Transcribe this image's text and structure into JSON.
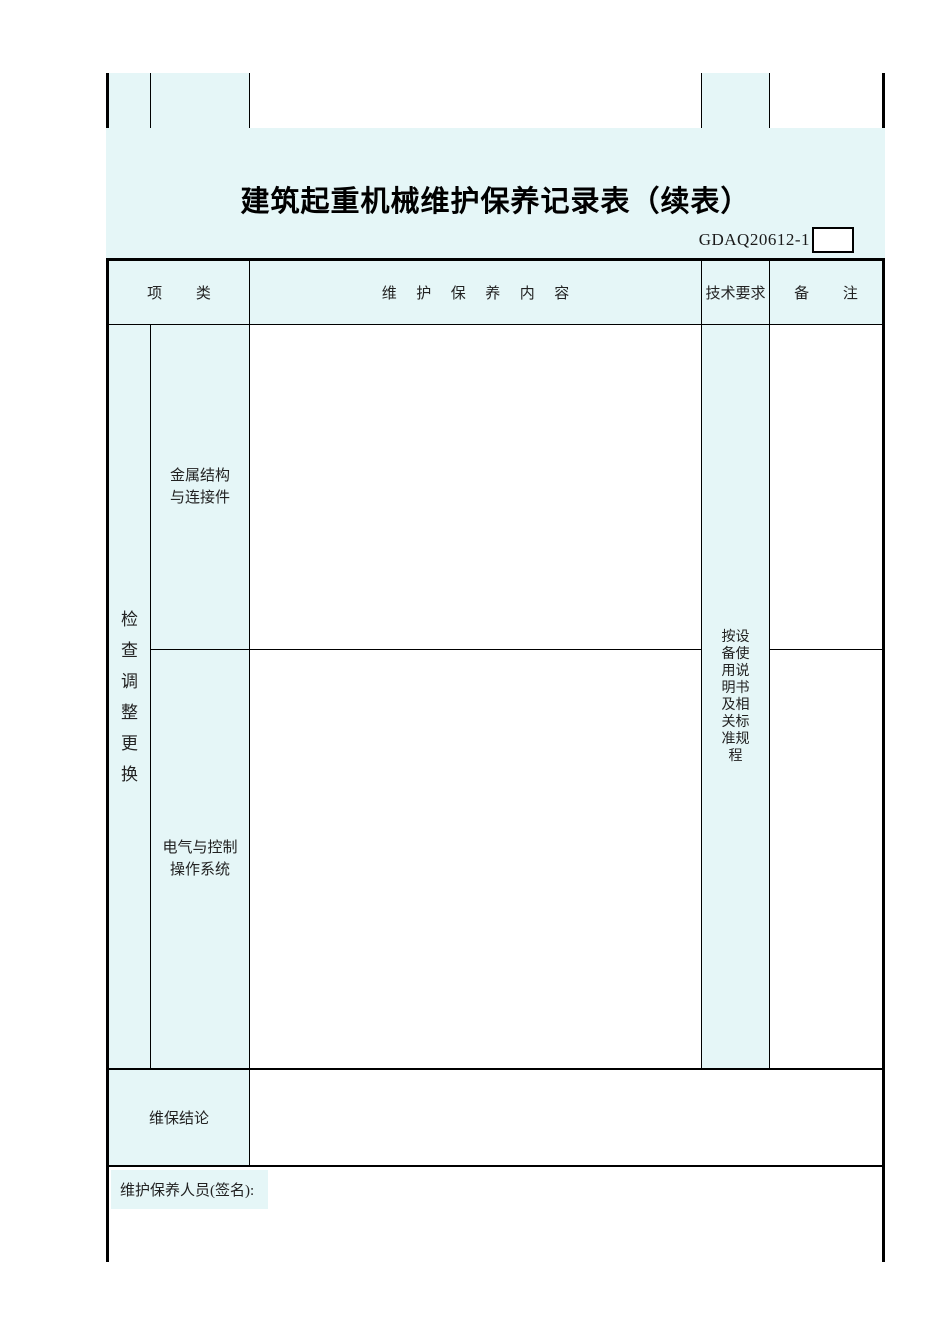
{
  "page": {
    "title": "建筑起重机械维护保养记录表（续表）",
    "form_code": "GDAQ20612-1"
  },
  "table": {
    "header": {
      "col_item_category": "项 类",
      "col_content": "维 护 保 养 内 容",
      "col_tech_requirements": "技术要求",
      "col_remarks": "备 注"
    },
    "body": {
      "action_group_label": "检查调整更换",
      "sub_rows": [
        {
          "category": "金属结构与连接件",
          "content": "",
          "remark": ""
        },
        {
          "category": "电气与控制操作系统",
          "content": "",
          "remark": ""
        }
      ],
      "tech_requirement_value": "按设备使用说明书及相关标准规程",
      "conclusion_label": "维保结论",
      "conclusion_value": "",
      "signature_label": "维护保养人员(签名):"
    }
  },
  "colors": {
    "cell_fill": "#e5f6f7",
    "border": "#000000"
  }
}
